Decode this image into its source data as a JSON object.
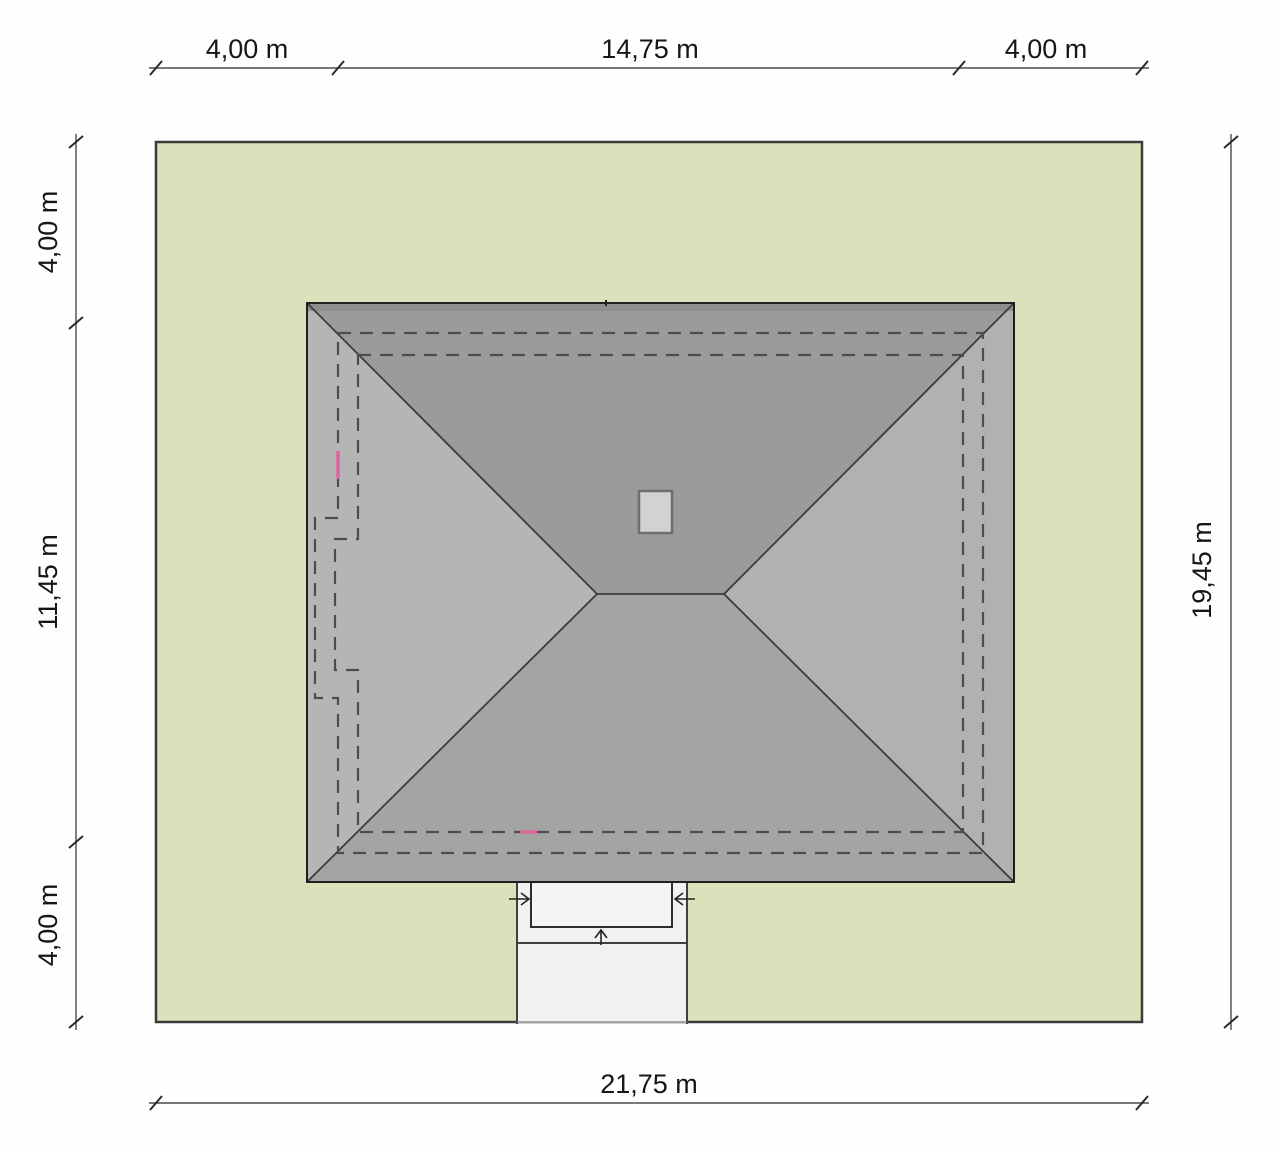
{
  "site_plan": {
    "dimensions": {
      "top_left": "4,00 m",
      "top_middle": "14,75 m",
      "top_right": "4,00 m",
      "left_top": "4,00 m",
      "left_middle": "11,45 m",
      "left_bottom": "4,00 m",
      "right_full": "19,45 m",
      "bottom_full": "21,75 m"
    },
    "colors": {
      "plot_fill": "#dce1bb",
      "plot_border": "#3b3b3b",
      "roof_north": "#9b9b9b",
      "roof_south": "#a4a4a4",
      "roof_west": "#b5b5b5",
      "roof_east": "#b1b1b1",
      "roof_eave_band": "#8e8e8e",
      "chimney_fill": "#d2d2d2",
      "chimney_border": "#6e6e6e",
      "driveway_fill": "#f1f1ef",
      "porch_fill": "#f4f4f2",
      "accent_pink": "#d9679e",
      "dashed_line": "#4d4d4d",
      "dimension_line": "#4c4c4c"
    }
  }
}
